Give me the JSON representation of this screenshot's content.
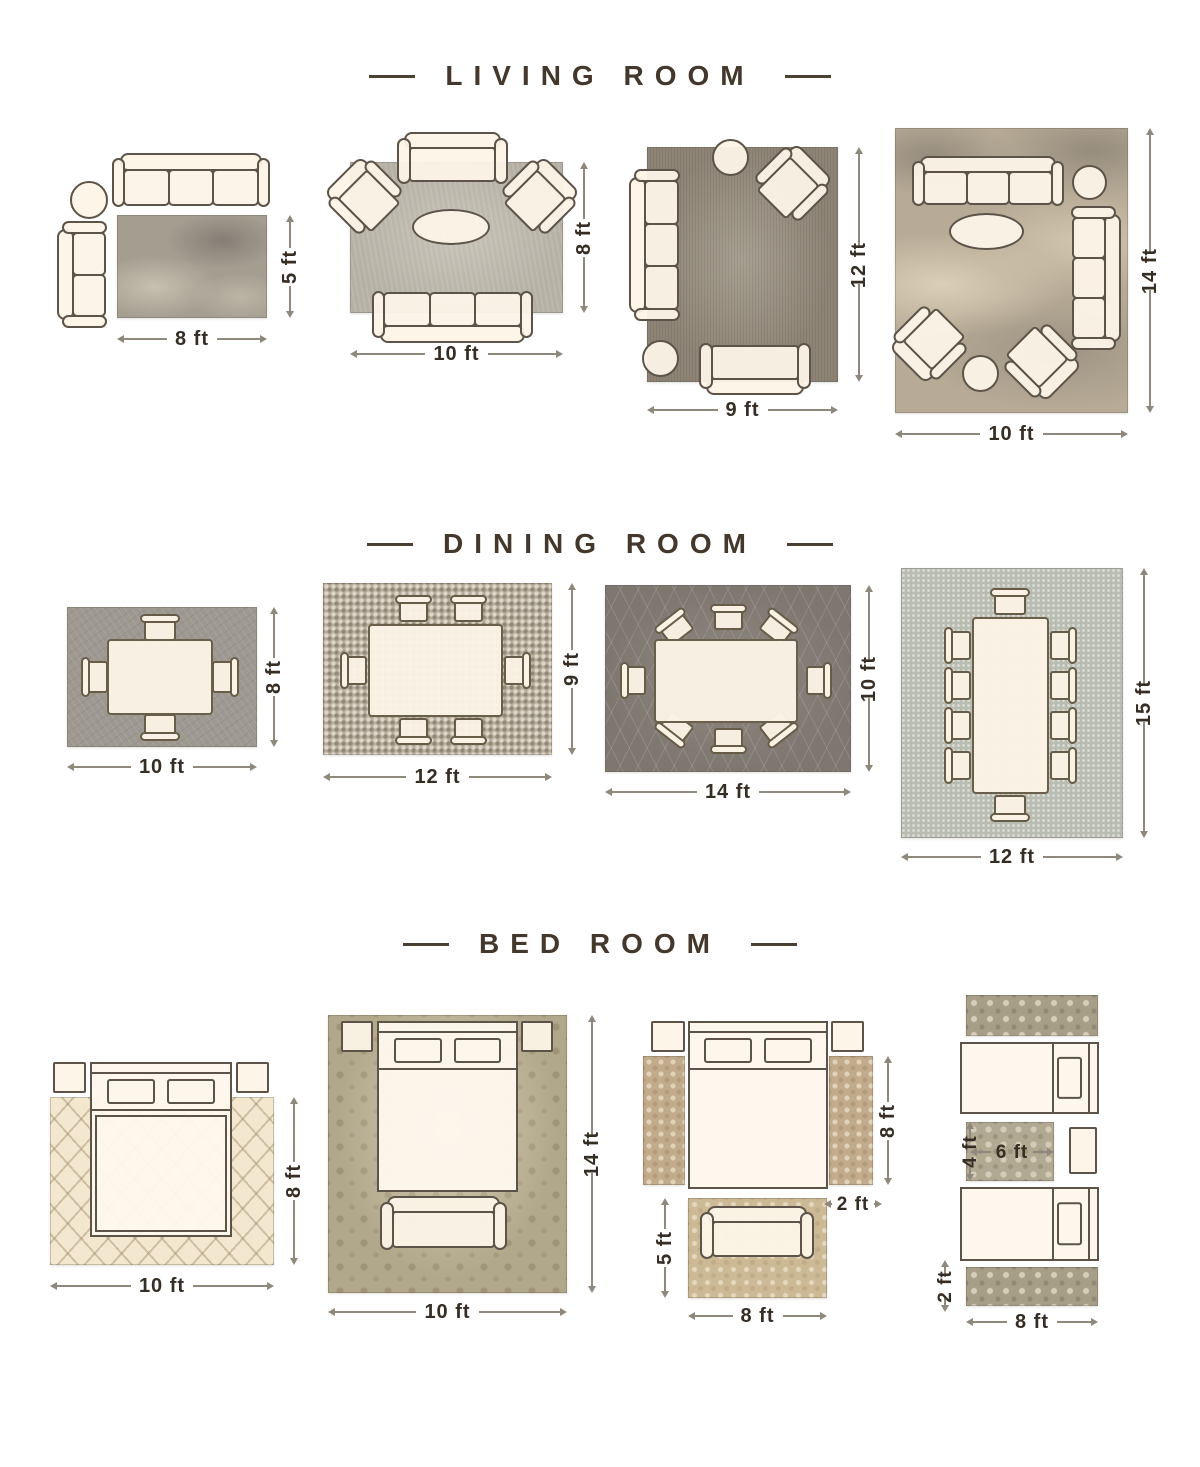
{
  "page": {
    "background": "#ffffff",
    "title_color": "#43382b",
    "label_color": "#362d24",
    "dim_line_color": "#8f887c",
    "furniture_outline": "#5d5348",
    "furniture_fill": "#fbf3e6"
  },
  "sections": [
    {
      "title": "LIVING ROOM",
      "layouts": [
        {
          "rug_width": "8 ft",
          "rug_height": "5 ft"
        },
        {
          "rug_width": "10 ft",
          "rug_height": "8 ft"
        },
        {
          "rug_width": "9 ft",
          "rug_height": "12 ft"
        },
        {
          "rug_width": "10 ft",
          "rug_height": "14 ft"
        }
      ]
    },
    {
      "title": "DINING ROOM",
      "layouts": [
        {
          "rug_width": "10 ft",
          "rug_height": "8 ft"
        },
        {
          "rug_width": "12 ft",
          "rug_height": "9 ft"
        },
        {
          "rug_width": "14 ft",
          "rug_height": "10 ft"
        },
        {
          "rug_width": "12 ft",
          "rug_height": "15 ft"
        }
      ]
    },
    {
      "title": "BED ROOM",
      "layouts": [
        {
          "rug_width": "10 ft",
          "rug_height": "8 ft"
        },
        {
          "rug_width": "10 ft",
          "rug_height": "14 ft"
        },
        {
          "runner_length": "8 ft",
          "runner_width": "2 ft",
          "foot_rug_height": "5 ft",
          "foot_rug_width": "8 ft"
        },
        {
          "accent_rug_height": "4 ft",
          "accent_rug_width": "6 ft",
          "runner_width": "2 ft",
          "runner_length": "8 ft"
        }
      ]
    }
  ]
}
